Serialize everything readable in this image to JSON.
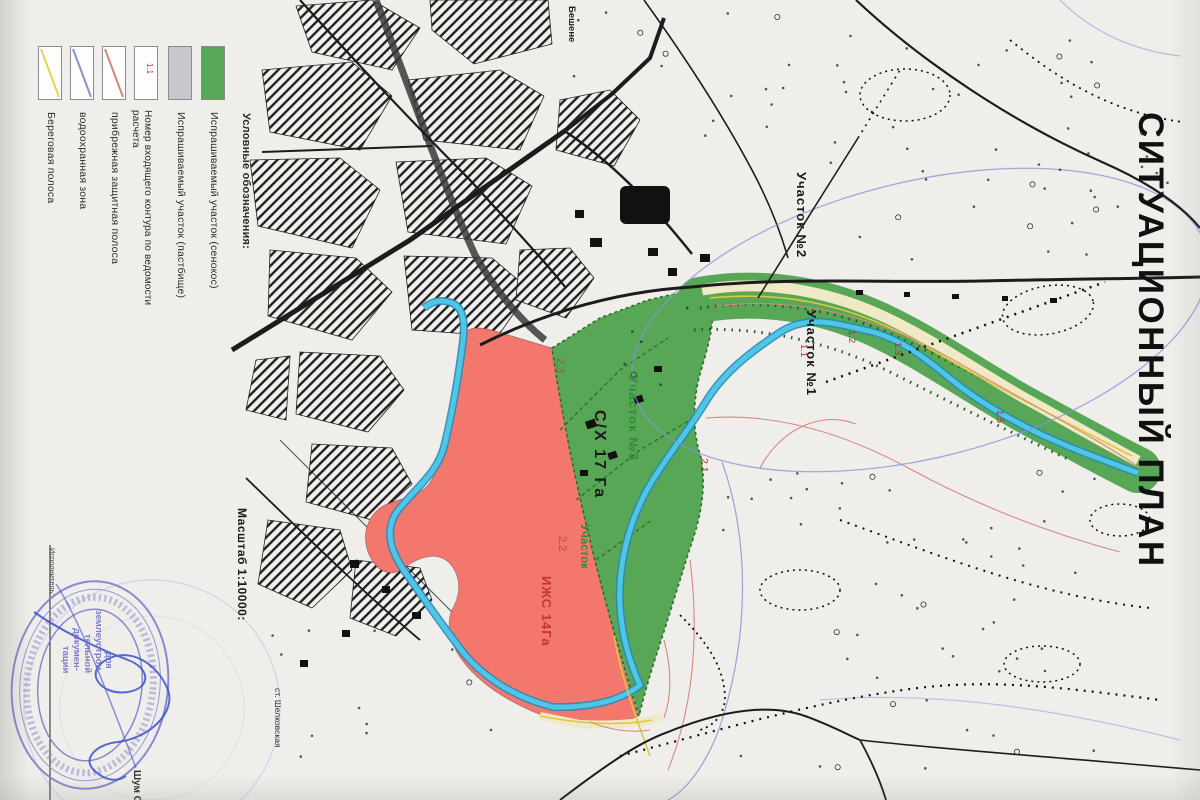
{
  "title": "СИТУАЦИОННЫЙ ПЛАН",
  "legend": {
    "header": "Условные обозначения:",
    "items": [
      {
        "label": "Испрашиваемый участок (сенокос)",
        "swatch": "fill",
        "color": "#57a757"
      },
      {
        "label": "Испрашиваемый участок (пастбище)",
        "swatch": "fill",
        "color": "#c8c6cb"
      },
      {
        "label": "Номер входящего контура по ведомости расчета",
        "swatch": "number",
        "number": "1.1",
        "color": "#cc3344"
      },
      {
        "label": "прибрежная защитная полоса",
        "swatch": "diagonal",
        "color": "#cc8878"
      },
      {
        "label": "водоохранная зона",
        "swatch": "diagonal",
        "color": "#8890d0"
      },
      {
        "label": "Береговая полоса",
        "swatch": "diagonal",
        "color": "#e4d44e"
      }
    ]
  },
  "scale_label": "Масштаб 1:10000:",
  "station_label": "ст. Шелковская",
  "map_labels": [
    {
      "text": "Участок №2"
    },
    {
      "text": "Участок №1"
    },
    {
      "text": "Участок №3"
    },
    {
      "text": "Участок"
    },
    {
      "text": "2.2"
    },
    {
      "text": "С/Х 17 Га"
    },
    {
      "text": "ИЖС 14Га"
    },
    {
      "text": "2.3"
    },
    {
      "text": "2.1"
    },
    {
      "text": "1.1"
    },
    {
      "text": "1.2"
    },
    {
      "text": "1.3"
    },
    {
      "text": "1.5"
    },
    {
      "text": "Бешене"
    }
  ],
  "stamp": {
    "lines": [
      "для",
      "землеустрои-",
      "тельной",
      "докумен-",
      "тации"
    ]
  },
  "executor": {
    "label": "Исполнитель:",
    "name": "Шум С."
  },
  "colors": {
    "river": "#4ec7e6",
    "river_edge": "#2e86b8",
    "parcel_green": "#57a757",
    "parcel_pink": "#f4776e",
    "road": "#1c1c1c",
    "stamp": "#8080cc",
    "water_zone_line": "#8894d8",
    "riparian_line": "#d88880",
    "coastal_line": "#ddc83e"
  }
}
